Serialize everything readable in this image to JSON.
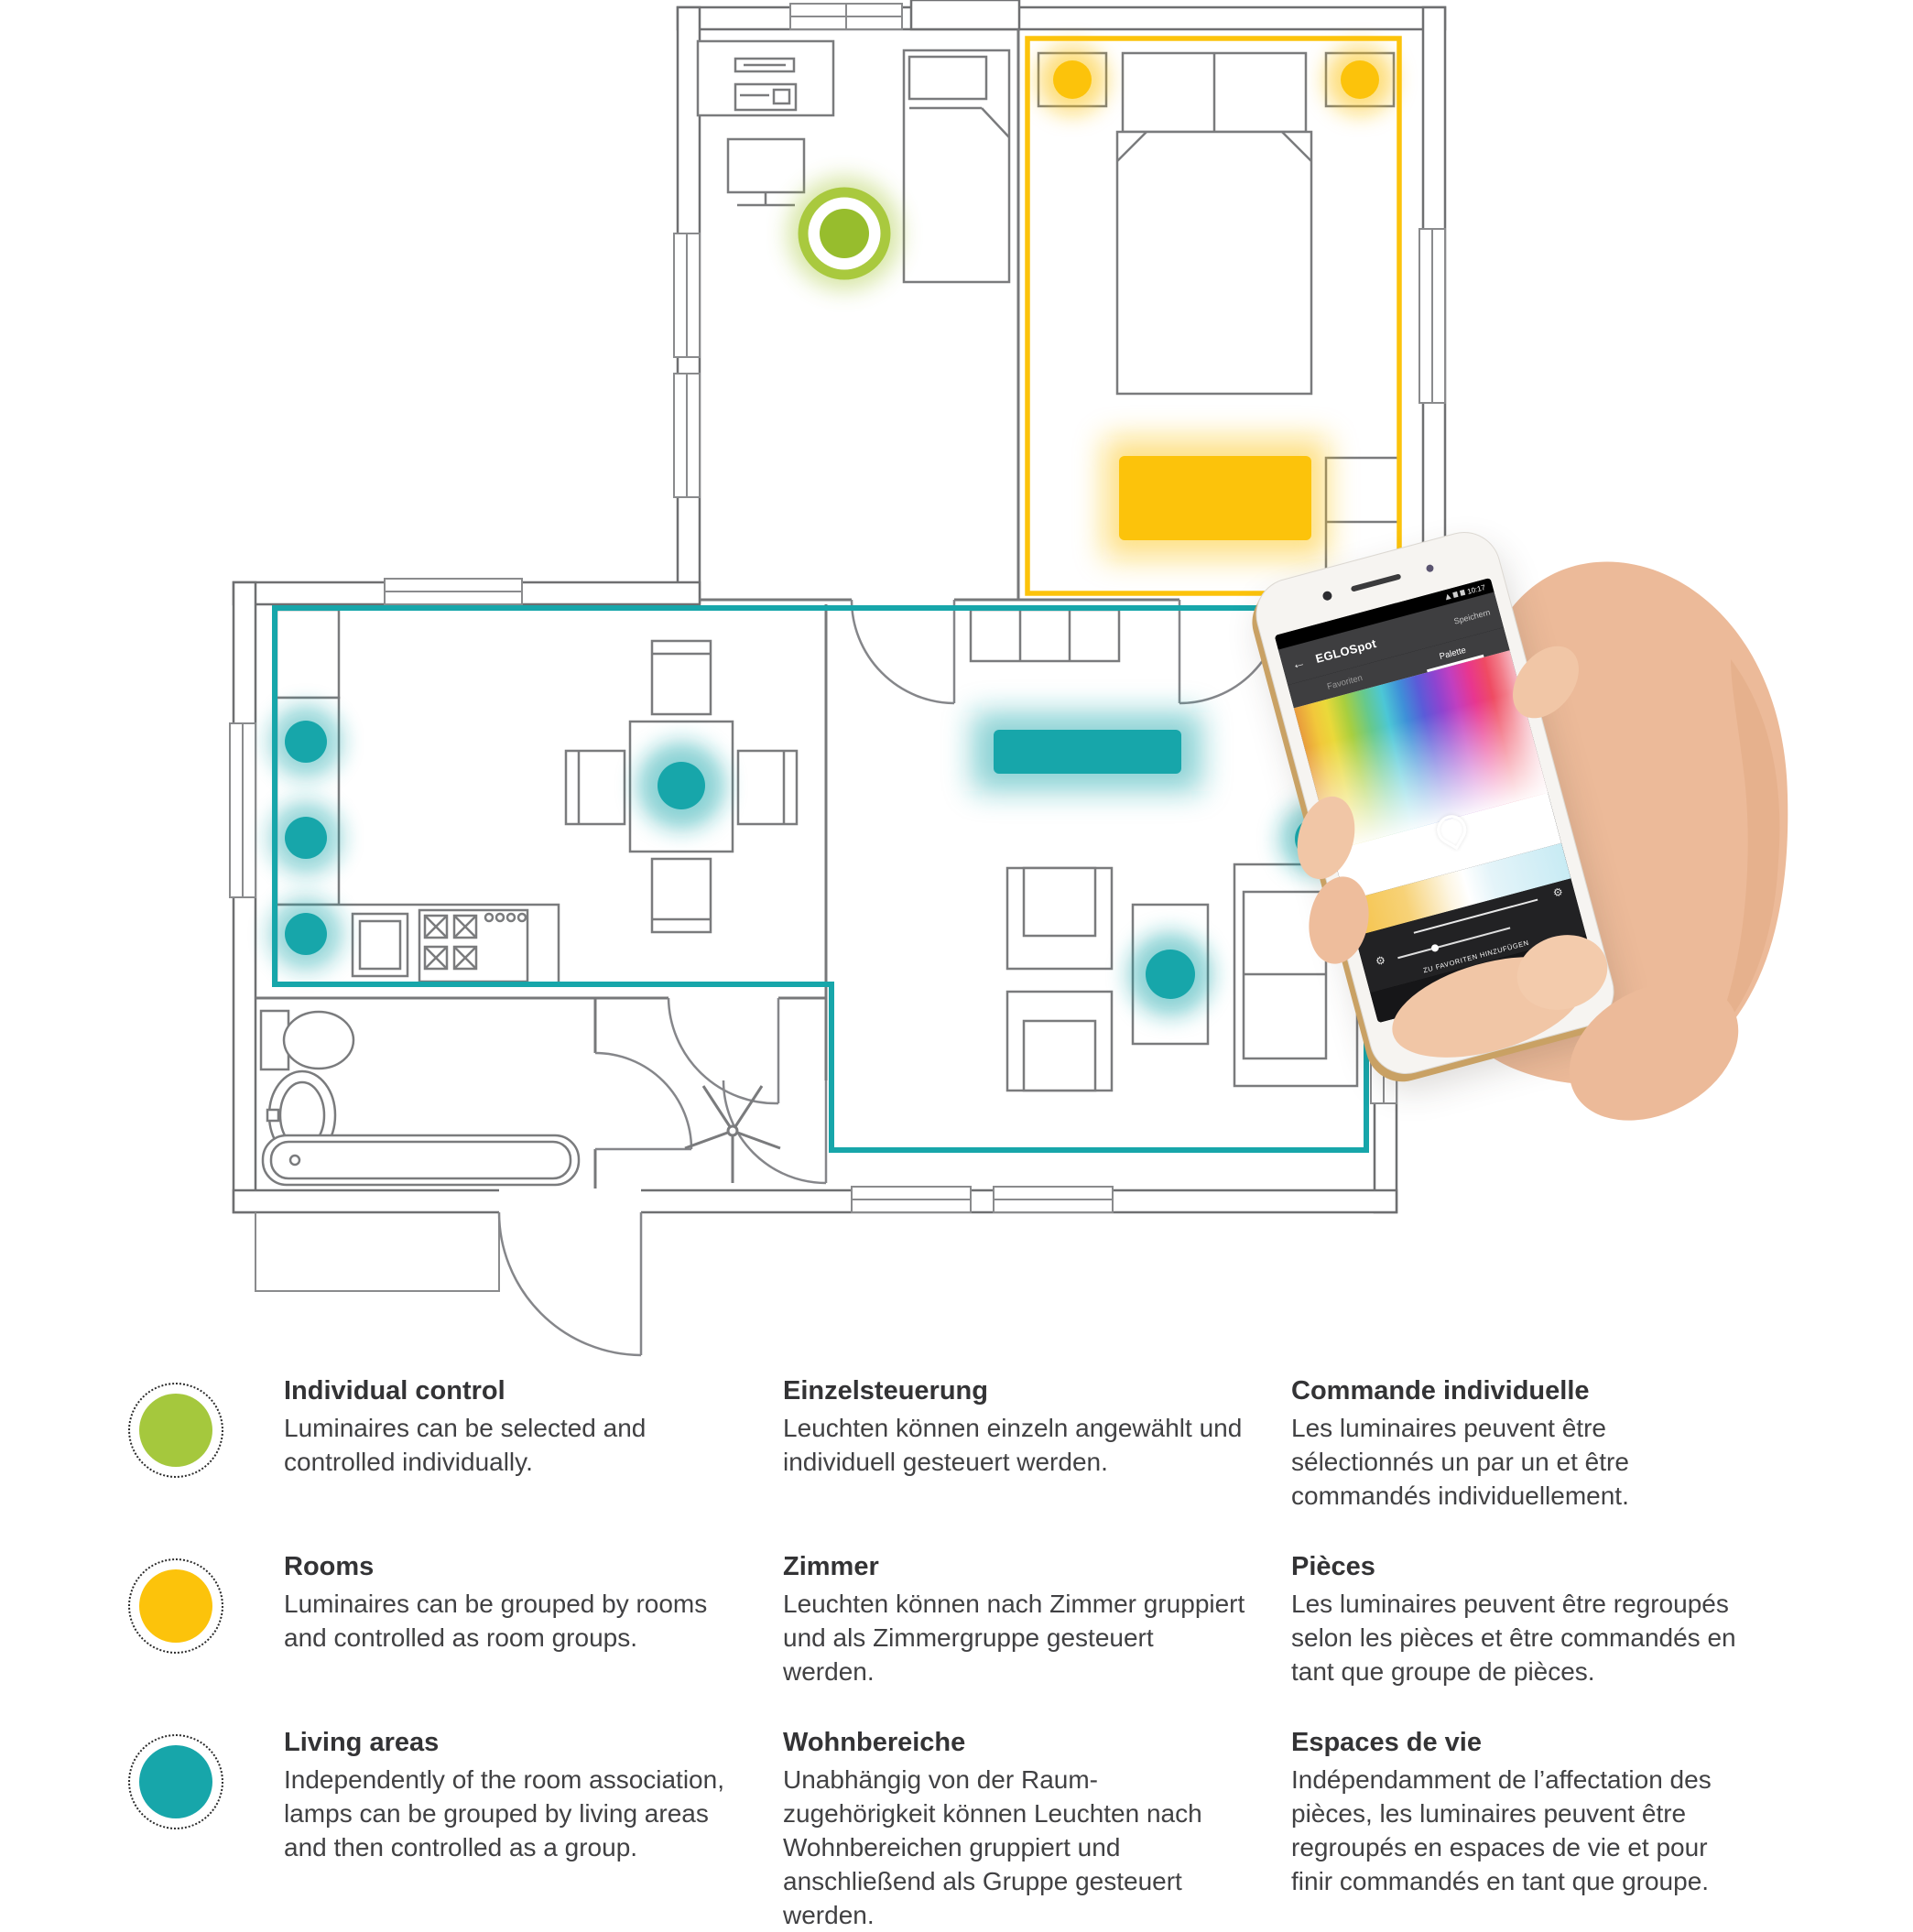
{
  "colors": {
    "green_ring": "#a9c93e",
    "green_core": "#97bd2d",
    "yellow": "#fcc30b",
    "teal": "#17a6aa",
    "wall_gray": "#77787a"
  },
  "phone": {
    "status_time": "10:17",
    "app_title": "EGLOSpot",
    "action_label": "Speichern",
    "tab_favorites": "Favoriten",
    "tab_palette": "Palette",
    "favorites_caption": "ZU FAVORITEN HINZUFÜGEN",
    "nav_back": "◁",
    "nav_home": "○",
    "nav_recent": "□",
    "back_arrow": "←",
    "gear": "⚙"
  },
  "legend": {
    "rows": [
      {
        "color": "#a5c83d",
        "en": {
          "title": "Individual control",
          "body": "Luminaires can be selected and controlled individually."
        },
        "de": {
          "title": "Einzelsteuerung",
          "body": "Leuchten können einzeln angewählt und individuell gesteuert werden."
        },
        "fr": {
          "title": "Commande individuelle",
          "body": "Les luminaires peuvent être sélectionnés un par un et être commandés individuellement."
        }
      },
      {
        "color": "#fcc30b",
        "en": {
          "title": "Rooms",
          "body": "Luminaires can be grouped by rooms and controlled as room groups."
        },
        "de": {
          "title": "Zimmer",
          "body": "Leuchten können nach Zimmer gruppiert und als Zimmergruppe gesteuert werden."
        },
        "fr": {
          "title": "Pièces",
          "body": "Les luminaires peuvent être regroupés selon les pièces et être commandés en tant que groupe de pièces."
        }
      },
      {
        "color": "#17a6aa",
        "en": {
          "title": "Living areas",
          "body": "Independently of the room association, lamps can be grouped by living areas and then controlled as a group."
        },
        "de": {
          "title": "Wohnbereiche",
          "body": "Unabhängig von der Raum-zugehörigkeit können Leuchten nach Wohnbereichen gruppiert und anschließend als Gruppe gesteuert werden."
        },
        "fr": {
          "title": "Espaces de vie",
          "body": "Indépendamment de l’affectation des pièces, les luminaires peuvent être regroupés en espaces de vie et pour finir commandés en tant que groupe."
        }
      }
    ]
  }
}
